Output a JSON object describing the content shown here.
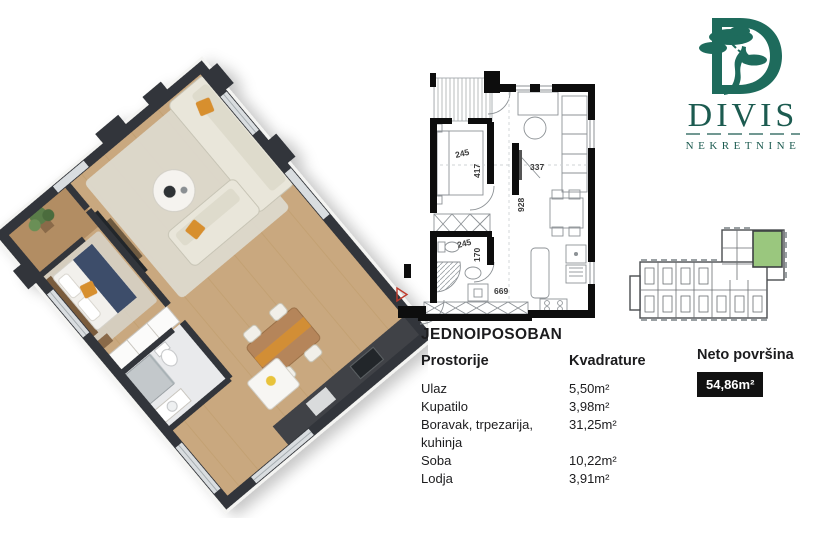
{
  "brand": {
    "name": "DIVIS",
    "subtitle": "NEKRETNINE",
    "logo_icon": "bonsai-tree-in-letter-d",
    "color": "#1E6B5C"
  },
  "listing": {
    "type_title": "JEDNOIPOSOBAN",
    "rooms_header": "Prostorije",
    "area_header": "Kvadrature",
    "rooms": [
      {
        "name": "Ulaz",
        "area": "5,50m²"
      },
      {
        "name": "Kupatilo",
        "area": "3,98m²"
      },
      {
        "name": "Boravak, trpezarija, kuhinja",
        "area": "31,25m²"
      },
      {
        "name": "Soba",
        "area": "10,22m²"
      },
      {
        "name": "Lodja",
        "area": "3,91m²"
      }
    ],
    "net_area_label": "Neto površina",
    "net_area_value": "54,86m²"
  },
  "floorplan2d": {
    "dims": {
      "bedroom_w": "245",
      "bedroom_h": "417",
      "living_w": "337",
      "corridor_h": "928",
      "bath_w": "245",
      "bath_h": "170",
      "bottom_w": "669"
    },
    "entrance_marker": "red-entry-arrow"
  },
  "keyplan": {
    "highlighted_unit": "current-apartment",
    "highlight_color": "#9AC77E"
  },
  "colors": {
    "wall_dark": "#33363A",
    "wood": "#C9A87F",
    "accent_orange": "#D78F2E",
    "badge_bg": "#111111",
    "badge_text": "#FFFFFF"
  }
}
